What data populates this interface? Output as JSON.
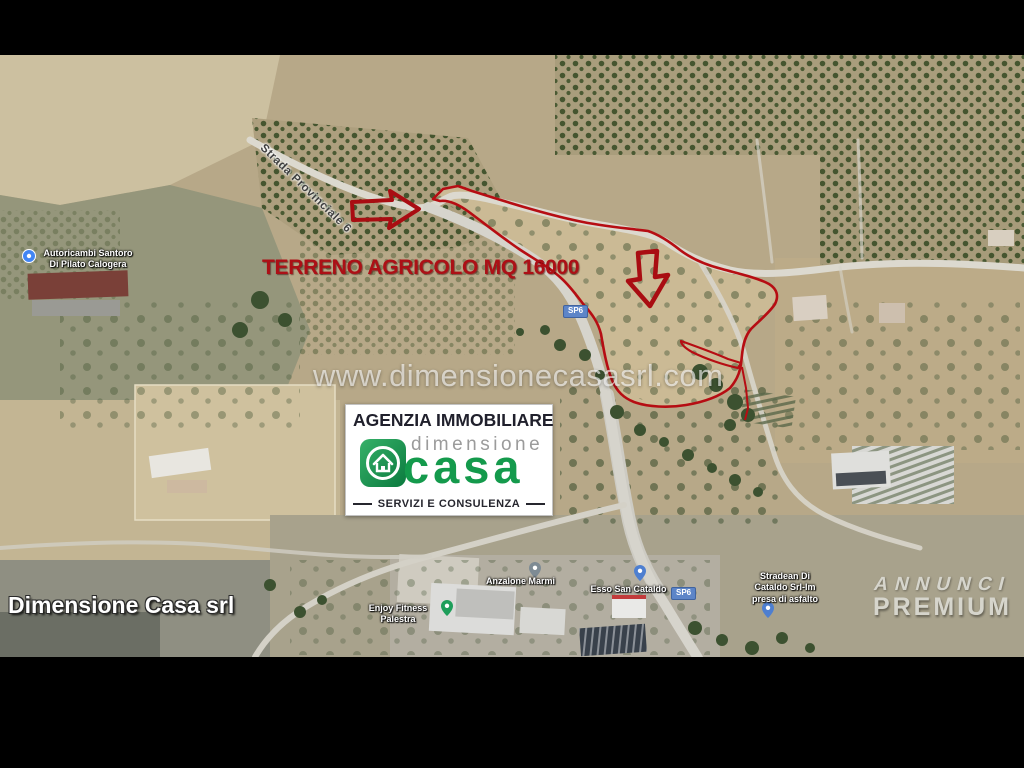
{
  "overlay": {
    "parcel_label": "TERRENO AGRICOLO MQ 16000",
    "watermark_url": "www.dimensionecasasrl.com",
    "agency_credit": "Dimensione Casa srl",
    "premium_badge": {
      "line1": "ANNUNCI",
      "line2": "PREMIUM"
    }
  },
  "logo_card": {
    "header": "AGENZIA IMMOBILIARE",
    "brand_small": "dimensione",
    "brand_large": "casa",
    "tagline": "SERVIZI E CONSULENZA"
  },
  "map": {
    "road_label": "Strada Provinciale 6",
    "route_badges": [
      "SP6",
      "SP6"
    ],
    "poi": [
      {
        "id": "autoricambi",
        "lines": [
          "Autoricambi Santoro",
          "Di Pilato Calogera"
        ],
        "pin": "blue-circle-pin"
      },
      {
        "id": "anzalone",
        "lines": [
          "Anzalone Marmi"
        ],
        "pin": "gray-pin"
      },
      {
        "id": "esso",
        "lines": [
          "Esso San Cataldo"
        ],
        "pin": "blue-pin"
      },
      {
        "id": "fitness",
        "lines": [
          "Enjoy Fitness Palestra"
        ],
        "pin": "green-pin"
      },
      {
        "id": "strade",
        "lines": [
          "Stradean Di",
          "Cataldo Srl-Im",
          "presa di asfalto"
        ],
        "pin": "blue-pin"
      }
    ]
  },
  "colors": {
    "annotation_red": "#ac1016",
    "logo_green": "#149a4c",
    "badge_blue": "#5d85c8",
    "watermark_white": "rgba(255,255,255,0.62)"
  }
}
